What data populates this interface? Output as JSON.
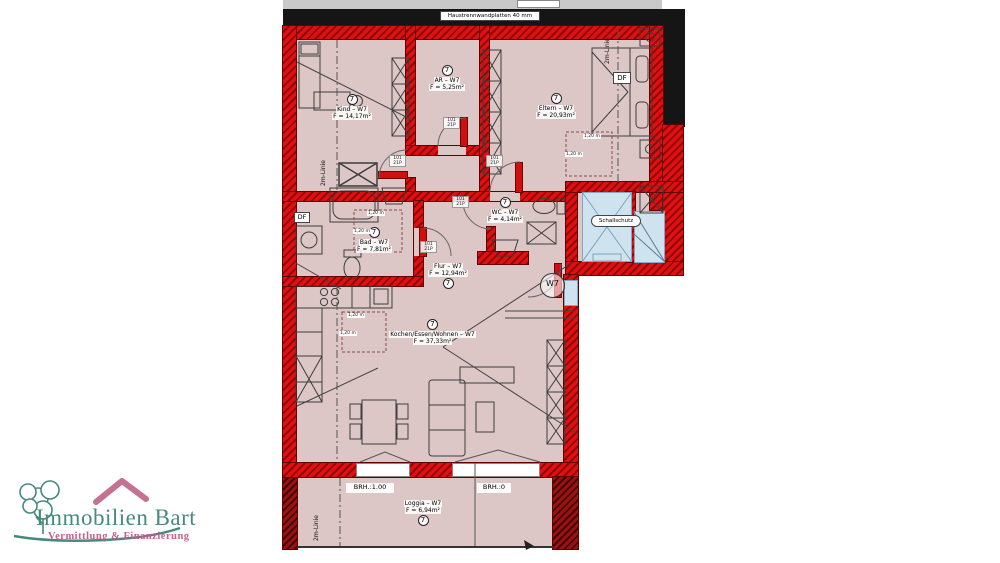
{
  "plan": {
    "separator_label": "Haustrennwandplatten 40 mm",
    "unit_badge": "7",
    "entrance_badge": "W7",
    "rooms": {
      "kind": {
        "name": "Kind – W7",
        "area": "F = 14,17m²"
      },
      "ar": {
        "name": "AR – W7",
        "area": "F = 5,25m²"
      },
      "eltern": {
        "name": "Eltern – W7",
        "area": "F = 20,93m²"
      },
      "bad": {
        "name": "Bad – W7",
        "area": "F = 7,81m²"
      },
      "wc": {
        "name": "WC – W7",
        "area": "F = 4,14m²"
      },
      "flur": {
        "name": "Flur – W7",
        "area": "F = 12,94m²"
      },
      "wohnen": {
        "name": "Kochen/Essen/Wohnen – W7",
        "area": "F = 37,33m²"
      },
      "loggia": {
        "name": "Loggia – W7",
        "area": "F = 6,94m²"
      }
    },
    "annotations": {
      "schallschutz": "Schallschutz",
      "df": "DF",
      "two_m_line": "2m-Linie",
      "brh_100": "BRH.:1.00",
      "brh_0": "BRH.:0",
      "dim_120": "1,20 m",
      "door_tag_line1": "101",
      "door_tag_line2": "21P"
    }
  },
  "logo": {
    "company": "Immobilien Bart",
    "tagline": "Vermittlung & Finanzierung"
  },
  "colors": {
    "wall_red": "#d60b0b",
    "wall_hatch": "#8f0606",
    "room_pink": "#dcc6c6",
    "shaft_blue": "#cfe3ef",
    "separator_black": "#151515",
    "logo_teal": "#47897e",
    "logo_rose": "#c4608d"
  }
}
